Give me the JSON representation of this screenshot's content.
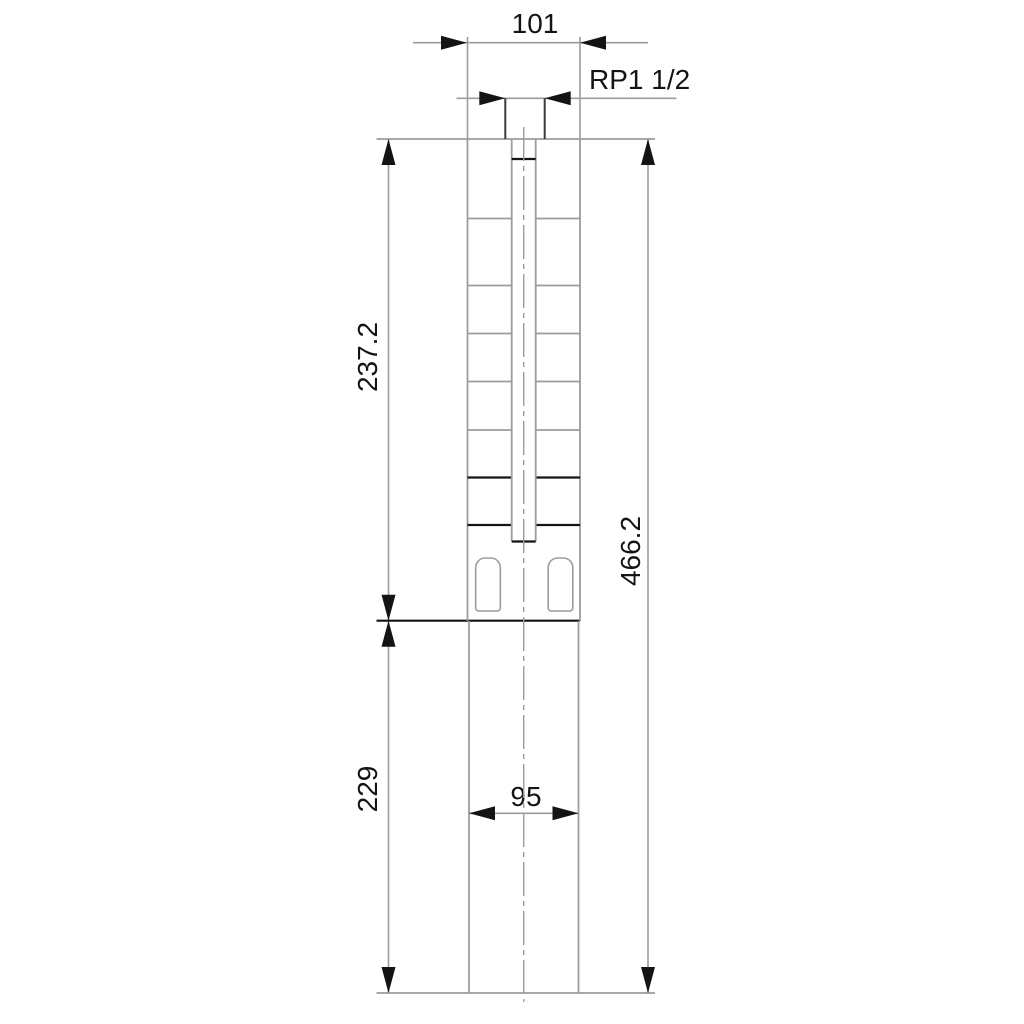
{
  "drawing": {
    "kind": "technical-dimension-drawing",
    "subject": "submersible pump outline with dimension lines",
    "units_shown": false
  },
  "colors": {
    "line_gray": "#9c9c9c",
    "line_dark": "#3c3c3c",
    "line_black": "#141414",
    "text_black": "#141414",
    "background": "#ffffff"
  },
  "dimensions": {
    "outlet_width": {
      "label": "101",
      "orientation": "horizontal",
      "position": "top"
    },
    "thread": {
      "label": "RP1 1/2",
      "orientation": "horizontal",
      "position": "top-connection"
    },
    "pump_section_length": {
      "label": "237.2",
      "orientation": "vertical",
      "position": "left-upper"
    },
    "motor_section_length": {
      "label": "229",
      "orientation": "vertical",
      "position": "left-lower"
    },
    "total_length": {
      "label": "466.2",
      "orientation": "vertical",
      "position": "right"
    },
    "motor_width": {
      "label": "95",
      "orientation": "horizontal",
      "position": "lower-body"
    }
  }
}
